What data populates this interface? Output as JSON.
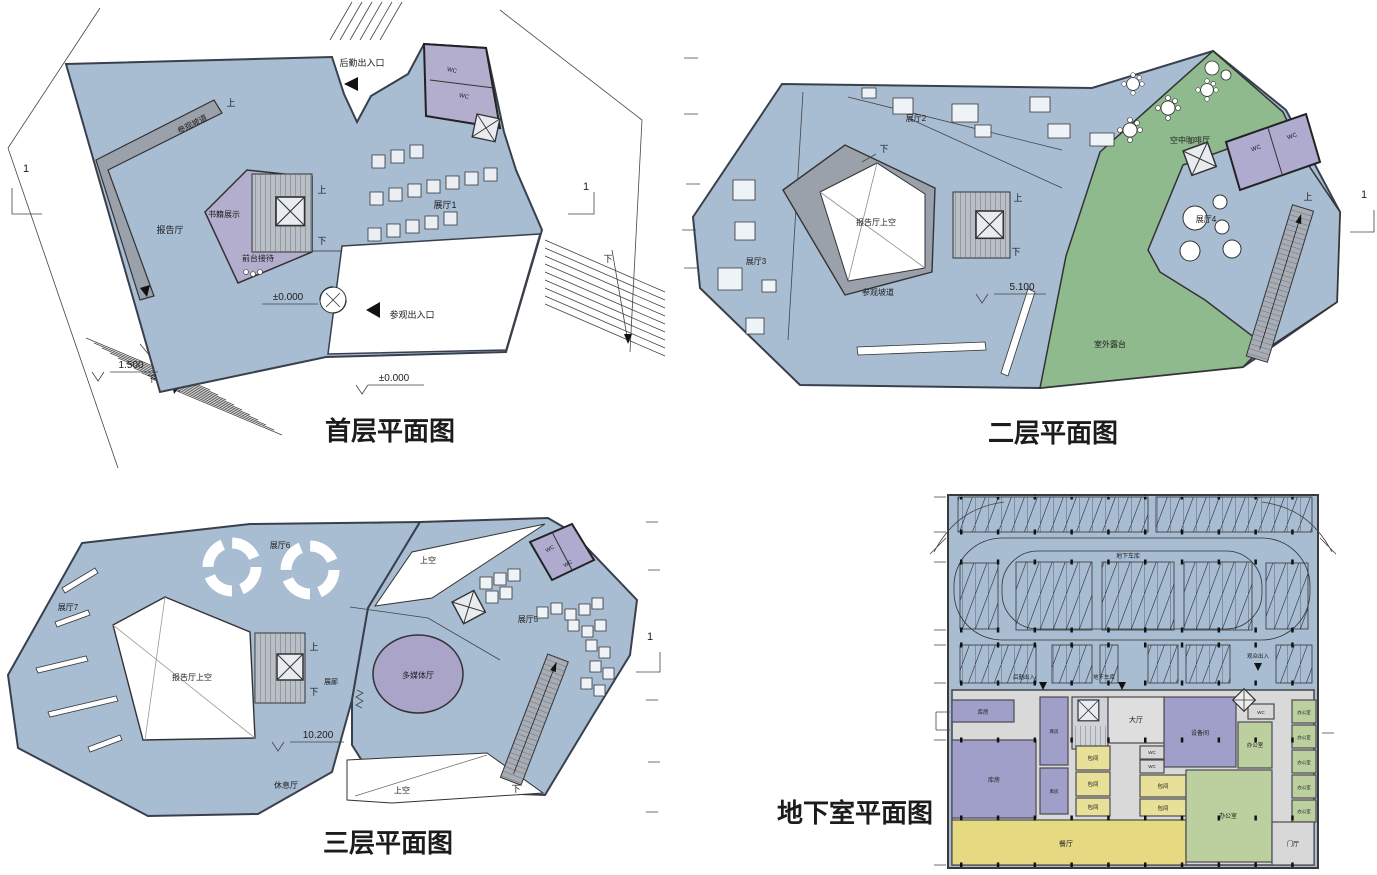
{
  "colors": {
    "floor_fill": "#a8bcd2",
    "ramp_gray": "#9aa1ab",
    "stair_gray": "#b9bfc7",
    "room_purple": "#aeabcf",
    "terrace_green": "#8fba8d",
    "void_white": "#ffffff",
    "basement_yellow": "#e8df98",
    "basement_dining": "#e5da82",
    "basement_green": "#bccf9f",
    "basement_purple": "#a09fc9",
    "corridor_gray": "#d9d9d9",
    "wall_line": "#39404d"
  },
  "markers": {
    "up": "上",
    "down": "下",
    "wc": "WC",
    "void": "上空",
    "section": "1"
  },
  "panels": {
    "floor1": {
      "title": "首层平面图",
      "labels": {
        "service_entrance": "后勤出入口",
        "visitor_entrance": "参观出入口",
        "ramp": "参观坡道",
        "hall": "报告厅",
        "books": "书籍展示",
        "reception": "前台接待",
        "exhibit1": "展厅1",
        "level_zero": "±0.000",
        "level_zero2": "±0.000",
        "level_150": "1.500"
      }
    },
    "floor2": {
      "title": "二层平面图",
      "labels": {
        "exhibit2": "展厅2",
        "exhibit3": "展厅3",
        "exhibit4": "展厅4",
        "hall_void": "报告厅上空",
        "ramp": "参观坡道",
        "cafe": "空中咖啡厅",
        "terrace": "室外露台",
        "level_510": "5.100"
      }
    },
    "floor3": {
      "title": "三层平面图",
      "labels": {
        "exhibit5": "展厅5",
        "exhibit6": "展厅6",
        "exhibit7": "展厅7",
        "hall_void": "报告厅上空",
        "multimedia": "多媒体厅",
        "lounge": "休息厅",
        "gallery": "展廊",
        "level_1020": "10.200"
      }
    },
    "basement": {
      "title": "地下室平面图",
      "labels": {
        "garage": "地下车库",
        "service_in": "后勤出入",
        "garage_in": "地下车库",
        "visitor_in": "观众出入",
        "hall": "大厅",
        "storage": "库房",
        "private_room": "包间",
        "dining": "餐厅",
        "office": "办公室",
        "equipment": "设备间",
        "foyer": "门厅"
      }
    }
  }
}
